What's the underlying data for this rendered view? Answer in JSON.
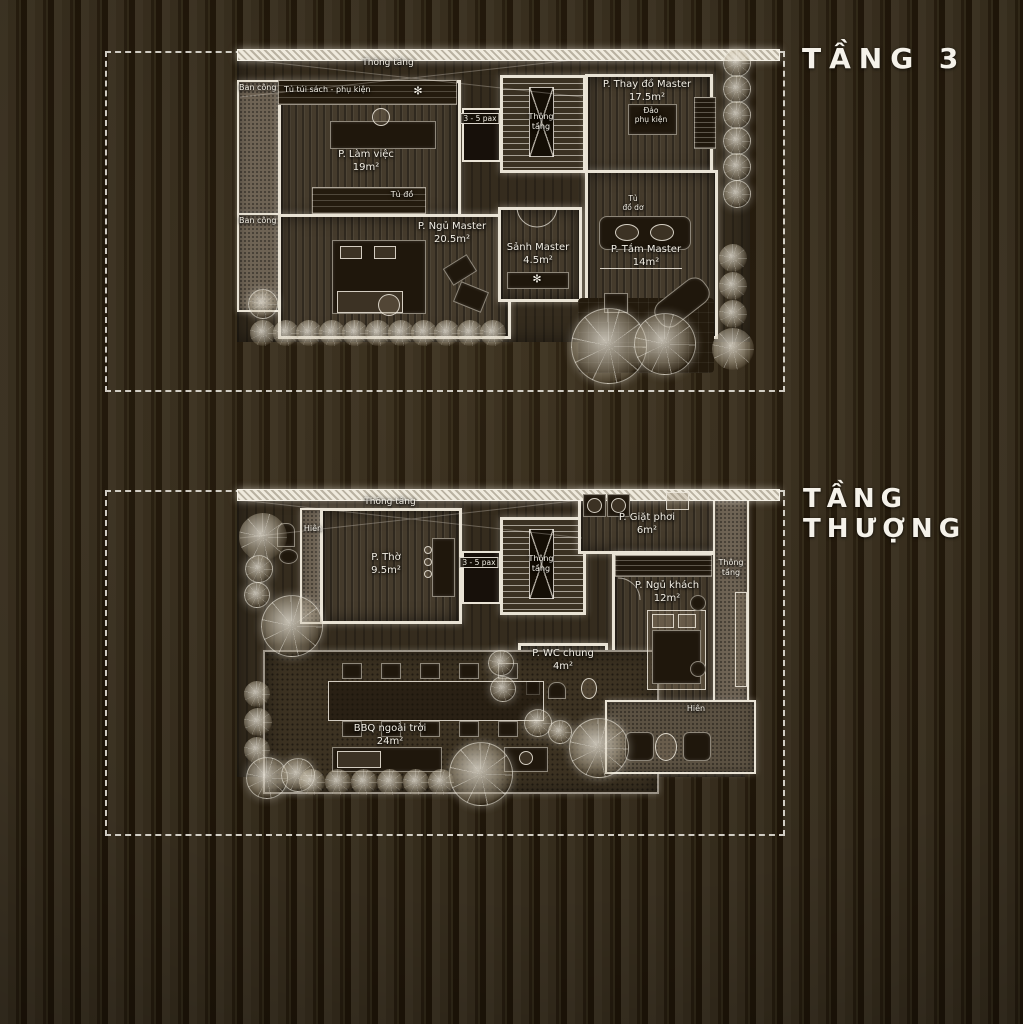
{
  "titles": {
    "floor3": "TẦNG 3",
    "roof_line1": "TẦNG",
    "roof_line2": "THƯỢNG"
  },
  "icons": {
    "fan": "✻"
  },
  "colors": {
    "background": "#332a1b",
    "stripe": "#1f1608",
    "wall": "#e9e3d5",
    "text": "#f2eee4"
  },
  "floor3": {
    "rooms": {
      "lam_viec": {
        "name": "P. Làm việc",
        "area": "19m²"
      },
      "ngu_master": {
        "name": "P. Ngủ Master",
        "area": "20.5m²"
      },
      "sanh_master": {
        "name": "Sảnh Master",
        "area": "4.5m²"
      },
      "thay_do": {
        "name": "P. Thay đồ Master",
        "area": "17.5m²"
      },
      "tam_master": {
        "name": "P. Tắm Master",
        "area": "14m²"
      }
    },
    "labels": {
      "void": "Thông tầng",
      "balcony_top": "Ban công",
      "balcony_bottom": "Ban công",
      "bookshelf": "Tủ túi sách - phụ kiện",
      "wardrobe": "Tủ đồ",
      "lift": "3 - 5 pax",
      "stairs_l1": "Thông",
      "stairs_l2": "tầng",
      "island_l1": "Đảo",
      "island_l2": "phụ kiện",
      "laundry_l1": "Tủ",
      "laundry_l2": "đồ dơ"
    }
  },
  "roof": {
    "rooms": {
      "tho": {
        "name": "P. Thờ",
        "area": "9.5m²"
      },
      "giat_phoi": {
        "name": "P. Giặt phơi",
        "area": "6m²"
      },
      "ngu_khach": {
        "name": "P. Ngủ khách",
        "area": "12m²"
      },
      "wc_chung": {
        "name": "P. WC chung",
        "area": "4m²"
      },
      "bbq": {
        "name": "BBQ ngoài trời",
        "area": "24m²"
      }
    },
    "labels": {
      "void": "Thông tầng",
      "porch_left": "Hiên",
      "porch_right": "Hiên",
      "lift": "3 - 5 pax",
      "stairs_l1": "Thông",
      "stairs_l2": "tầng",
      "shaft_l1": "Thông",
      "shaft_l2": "tầng"
    }
  }
}
